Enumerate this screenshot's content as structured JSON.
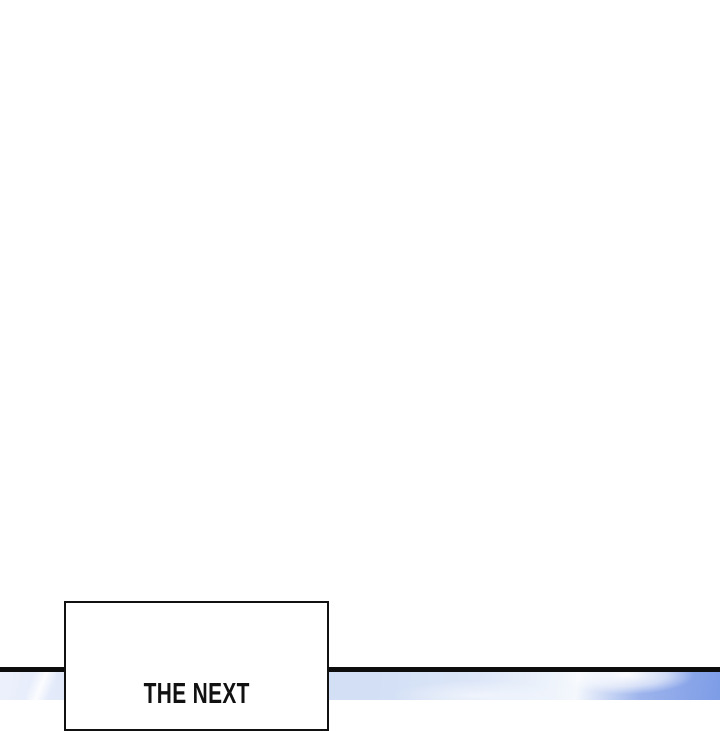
{
  "page": {
    "background": "#ffffff",
    "type": "webtoon-comic-panel"
  },
  "caption_box": {
    "text": "THE NEXT"
  },
  "colors": {
    "ink": "#111111",
    "divider": "#0d0d0d",
    "sky_pale_left": "#edf1fc",
    "sky_light_blue": "#d4e0f6",
    "sky_cloud_white": "#f4f8fd",
    "sky_deep_blue": "#7d9ce7"
  }
}
